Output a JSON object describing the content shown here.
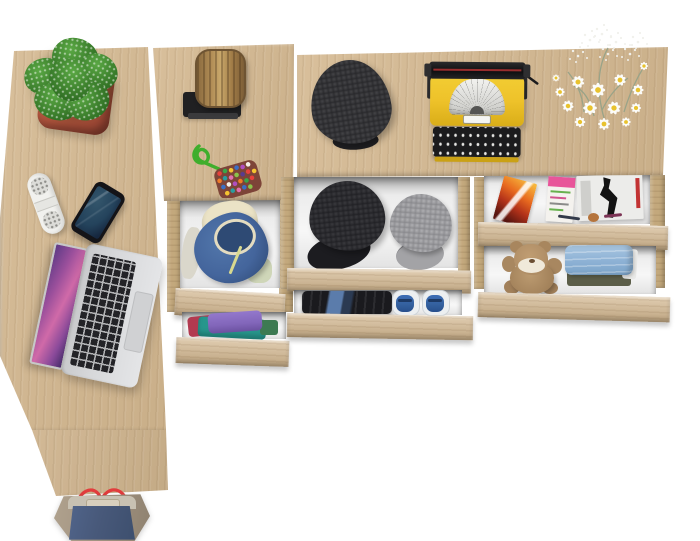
{
  "scene": {
    "type": "product-photo",
    "description": "Top-down view of a light oak furniture set: L-shaped desk, narrow chest and wide sideboard with open drawers, staged with home accessories on a white background",
    "furniture": [
      {
        "name": "desk",
        "description": "L-shaped desk top with lower return panel"
      },
      {
        "name": "narrow-chest",
        "description": "narrow chest with two open drawers"
      },
      {
        "name": "sideboard",
        "description": "long sideboard top over two drawer columns, two open drawers each"
      }
    ],
    "items": [
      {
        "name": "potted-plant",
        "location": "desk-top"
      },
      {
        "name": "white-speaker",
        "location": "desk-top"
      },
      {
        "name": "smartphone",
        "location": "desk-top"
      },
      {
        "name": "silver-laptop",
        "location": "desk-top"
      },
      {
        "name": "wood-stump-decor",
        "location": "narrow-chest-top"
      },
      {
        "name": "beaded-keychain",
        "location": "narrow-chest-top"
      },
      {
        "name": "blue-hooded-jacket",
        "location": "narrow-chest-drawer-1"
      },
      {
        "name": "folded-shirts",
        "location": "narrow-chest-drawer-2"
      },
      {
        "name": "gray-flat-cap",
        "location": "sideboard-top"
      },
      {
        "name": "yellow-typewriter",
        "location": "sideboard-top"
      },
      {
        "name": "daisy-bouquet",
        "location": "sideboard-top"
      },
      {
        "name": "black-cap",
        "location": "sideboard-left-drawer-1"
      },
      {
        "name": "gray-cap",
        "location": "sideboard-left-drawer-1"
      },
      {
        "name": "folded-dark-clothes",
        "location": "sideboard-left-drawer-2"
      },
      {
        "name": "blue-sneakers",
        "location": "sideboard-left-drawer-2"
      },
      {
        "name": "magazines",
        "location": "sideboard-right-drawer-1"
      },
      {
        "name": "teddy-bear",
        "location": "sideboard-right-drawer-2"
      },
      {
        "name": "folded-jeans",
        "location": "sideboard-right-drawer-2"
      },
      {
        "name": "tote-bag",
        "location": "below-desk"
      }
    ]
  },
  "palette": {
    "bg": "#ffffff",
    "wood": "#d4b890",
    "wood-light": "#e0c9a4",
    "wood-dark": "#c3a87c",
    "pot-red": "#b3553e",
    "leaf-green": "#5aa844",
    "leaf-dark": "#2d6b21",
    "stump-brown": "#a98a57",
    "base-black": "#202022",
    "cord-green": "#3fae2c",
    "cap-charcoal": "#333336",
    "cap-gray": "#9c9c9f",
    "typewriter-yellow": "#eec22a",
    "machine-black": "#1b1b1d",
    "paper-white": "#f2f2ef",
    "daisy-yellow": "#e8c22e",
    "hoodie-blue": "#44659c",
    "lining-cream": "#ebe3c6",
    "shirt-purple": "#8266ba",
    "shirt-teal": "#27968c",
    "shirt-red": "#b23a50",
    "clothes-black": "#1a1a1e",
    "sneaker-blue": "#34619f",
    "mag-orange": "#e86a1f",
    "teddy-brown": "#b29068",
    "jeans-blue": "#8fb3d6",
    "bag-navy": "#48597a",
    "bag-taupe": "#a39482",
    "strap-red": "#e23d3d",
    "laptop-silver": "#d7d8da",
    "key-black": "#232327",
    "phone-screen": "#24435c",
    "speaker-white": "#f1f1ee"
  }
}
